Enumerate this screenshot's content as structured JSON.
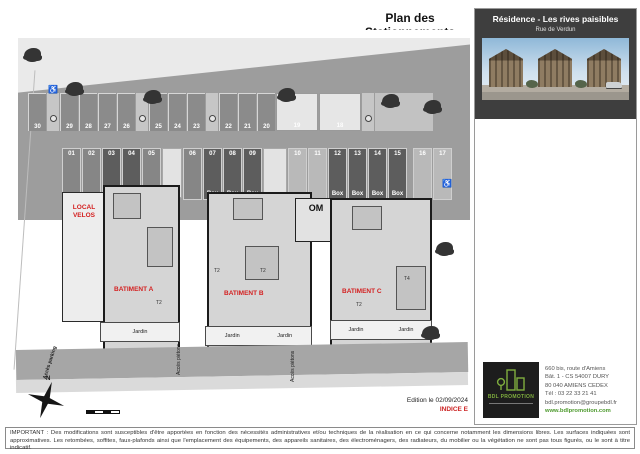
{
  "page": {
    "title": "Plan des Stationnements",
    "edition": "Edition le 02/09/2024",
    "indice": "INDICE E",
    "disclaimer": "IMPORTANT : Des modifications sont susceptibles d'être apportées en fonction des nécessités administratives et/ou techniques de la réalisation en ce qui concerne notamment les dimensions libres. Les surfaces indiquées sont approximatives. Les retombées, soffites, faux-plafonds ainsi que l'emplacement des équipements, des appareils sanitaires, des électroménagers, des radiateurs, du mobilier ou la végétation ne sont pas tous figurés, ou le sont à titre indicatif."
  },
  "panel": {
    "title": "Résidence - Les rives paisibles",
    "subtitle": "Rue de Verdun",
    "logo_text": "BDL PROMOTION",
    "contact": {
      "line1": "660 bis, route d'Amiens",
      "line2": "Bât. 1 - CS 54007 DURY",
      "line3": "80 040 AMIENS CEDEX",
      "line4": "Tél : 03 22 33 21 41",
      "line5": "bdl.promotion@groupebdl.fr",
      "website": "www.bdlpromotion.com"
    }
  },
  "plan": {
    "north_label": "N",
    "handicap_icon": "♿",
    "labels": {
      "local_velos_1": "LOCAL",
      "local_velos_2": "VELOS",
      "batiment_a": "BATIMENT A",
      "batiment_b": "BATIMENT B",
      "batiment_c": "BATIMENT C",
      "om": "OM",
      "jardin": "Jardin",
      "acces_pietons": "Accès piétons",
      "acces_parking": "Accès parking",
      "t2": "T2",
      "t4": "T4"
    },
    "top_stalls": [
      "30",
      "29",
      "28",
      "27",
      "26",
      "25",
      "24",
      "23",
      "22",
      "21",
      "20",
      "19",
      "18"
    ],
    "mid_stalls": [
      {
        "n": "01",
        "box": ""
      },
      {
        "n": "02",
        "box": ""
      },
      {
        "n": "03",
        "box": "Box"
      },
      {
        "n": "04",
        "box": "Box"
      },
      {
        "n": "05",
        "box": ""
      },
      {
        "n": "06",
        "box": ""
      },
      {
        "n": "07",
        "box": "Box"
      },
      {
        "n": "08",
        "box": "Box"
      },
      {
        "n": "09",
        "box": "Box"
      },
      {
        "n": "10",
        "box": ""
      },
      {
        "n": "11",
        "box": ""
      },
      {
        "n": "12",
        "box": "Box"
      },
      {
        "n": "13",
        "box": "Box"
      },
      {
        "n": "14",
        "box": "Box"
      },
      {
        "n": "15",
        "box": "Box"
      },
      {
        "n": "16",
        "box": ""
      },
      {
        "n": "17",
        "box": ""
      }
    ],
    "colors": {
      "red_label": "#d42020",
      "road": "#9d9d9d",
      "box_stall": "#5d5d5d",
      "panel_header": "#3e3e3e",
      "logo_green": "#7fae3e"
    }
  }
}
